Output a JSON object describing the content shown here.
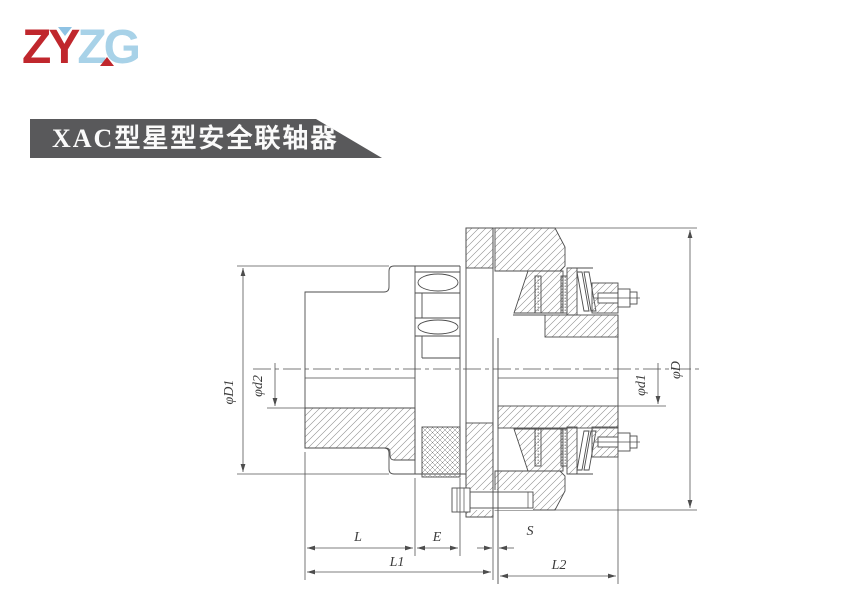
{
  "logo": {
    "zy": "ZY",
    "zg": "ZG",
    "red": "#c0272d",
    "blue": "#a8d2e8"
  },
  "banner": {
    "title": "XAC型星型安全联轴器",
    "bg": "#59595b",
    "fg": "#fafafa"
  },
  "drawing": {
    "labels": {
      "phiD1": "φD1",
      "phid2": "φd2",
      "phid1": "φd1",
      "phiD": "φD",
      "L": "L",
      "E": "E",
      "S": "S",
      "L1": "L1",
      "L2": "L2"
    },
    "line_color": "#4d4d4d"
  }
}
